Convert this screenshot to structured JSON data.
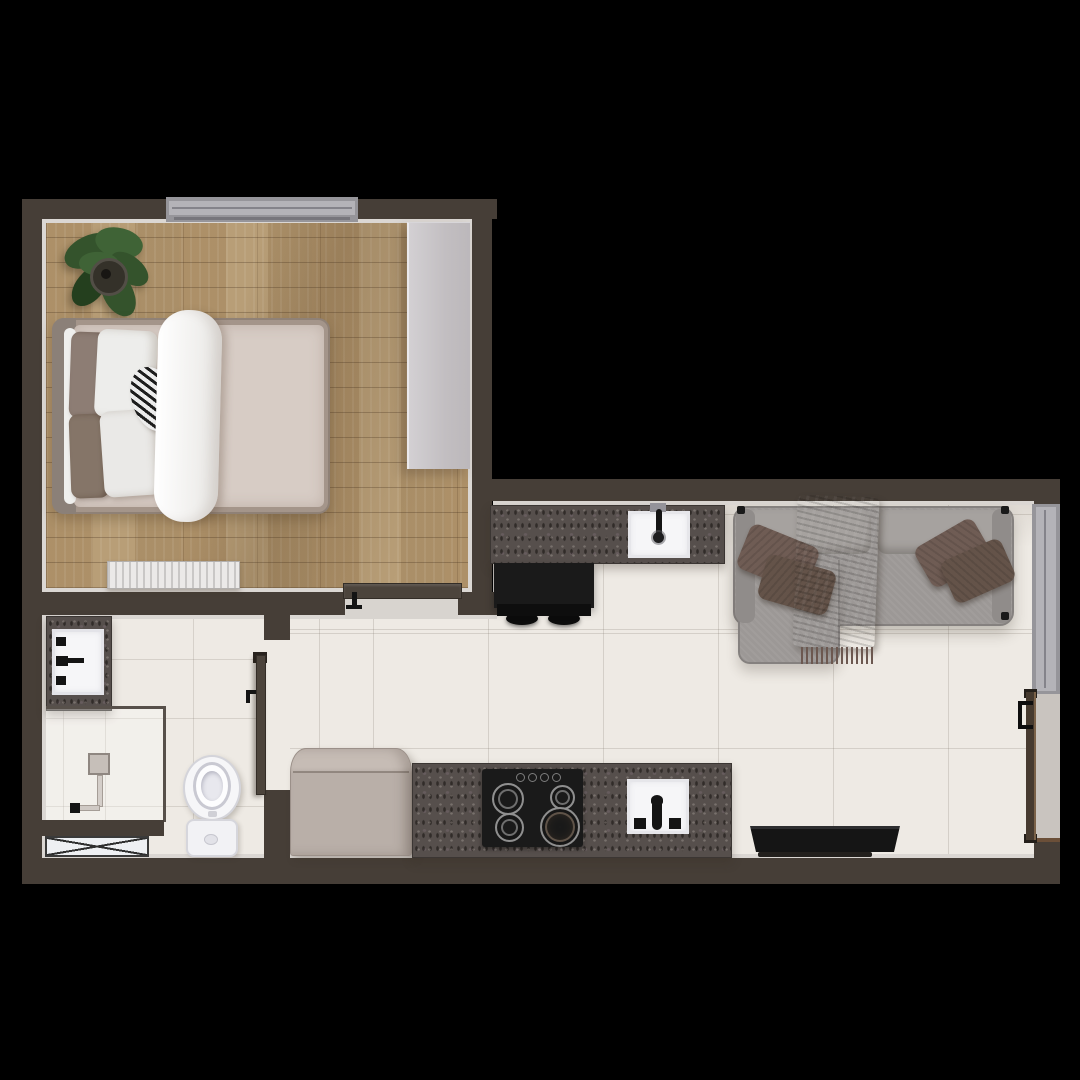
{
  "scene": {
    "kind": "floor-plan-render",
    "view": "top-down",
    "background": "black",
    "rooms": [
      {
        "name": "bedroom",
        "floor": "wood-planks",
        "objects": [
          "double-bed",
          "brown-pillows",
          "white-pillows",
          "striped-accent-pillow",
          "white-duvet-runner",
          "potted-plant",
          "wardrobe",
          "radiator",
          "window",
          "door"
        ]
      },
      {
        "name": "bathroom",
        "floor": "light-tile",
        "objects": [
          "vanity-sink",
          "shower-enclosure",
          "shower-column",
          "toilet",
          "utility-shaft",
          "door"
        ]
      },
      {
        "name": "kitchen-living-room",
        "floor": "light-tile",
        "objects": [
          "kitchen-counter-with-sink",
          "black-bar-table",
          "bar-stools",
          "sofa-with-chaise",
          "brown-throw-blanket",
          "brown-cushions",
          "window",
          "entrance-door",
          "fridge",
          "kitchen-counter-with-hob",
          "hob",
          "kitchen-sink",
          "tv"
        ]
      }
    ]
  },
  "palette": {
    "bg": "#000000",
    "wall": "#463e37",
    "liner": "#dbd7d3",
    "wood": "#b4986f",
    "tile": "#eeeae4",
    "counter": "#564f4c",
    "wardrobe": "#c9c5c8",
    "wardrobe_edge": "#ebe9ec",
    "window_frame": "#96959a",
    "window_glass": "#b4b3b8",
    "door_dark": "#4c443c",
    "entry_door": "#463a2f",
    "entry_door_edge": "#7a6148",
    "threshold": "#d8d4cf",
    "white_fixture": "#f6f6f8",
    "fixture_border": "#d2d2d8",
    "appliance_black": "#1a1a1a",
    "fridge": "#b9afa8",
    "fridge_top": "#c6bcb5",
    "sofa": "#9c9896",
    "sofa_back": "#a6a29f",
    "sofa_arm": "#908c8a",
    "cushion_brown": "#6f5c54",
    "cushion_brown_dark": "#645349",
    "throw": "#6c5850",
    "bed_frame": "#a4958a",
    "headboard": "#8b8078",
    "mattress": "#d7ccc5",
    "duvet": "#f3f2f0",
    "pillow_white": "#ededeb",
    "pillow_brown": "#8d7d74",
    "pillow_brown_dark": "#857568",
    "radiator_light": "#ebe9e8",
    "radiator_dark": "#c9c7c6",
    "plant_leaf": "#34532c",
    "plant_leaf_dark": "#243f1e",
    "plant_leaf_light": "#3f6336",
    "plant_pot": "#343129",
    "tv": "#151515",
    "tv_top": "#2e2e30",
    "stool": "#0c0c0c",
    "glass_line": "#57504a",
    "shower_metal": "#c6bfb9"
  }
}
